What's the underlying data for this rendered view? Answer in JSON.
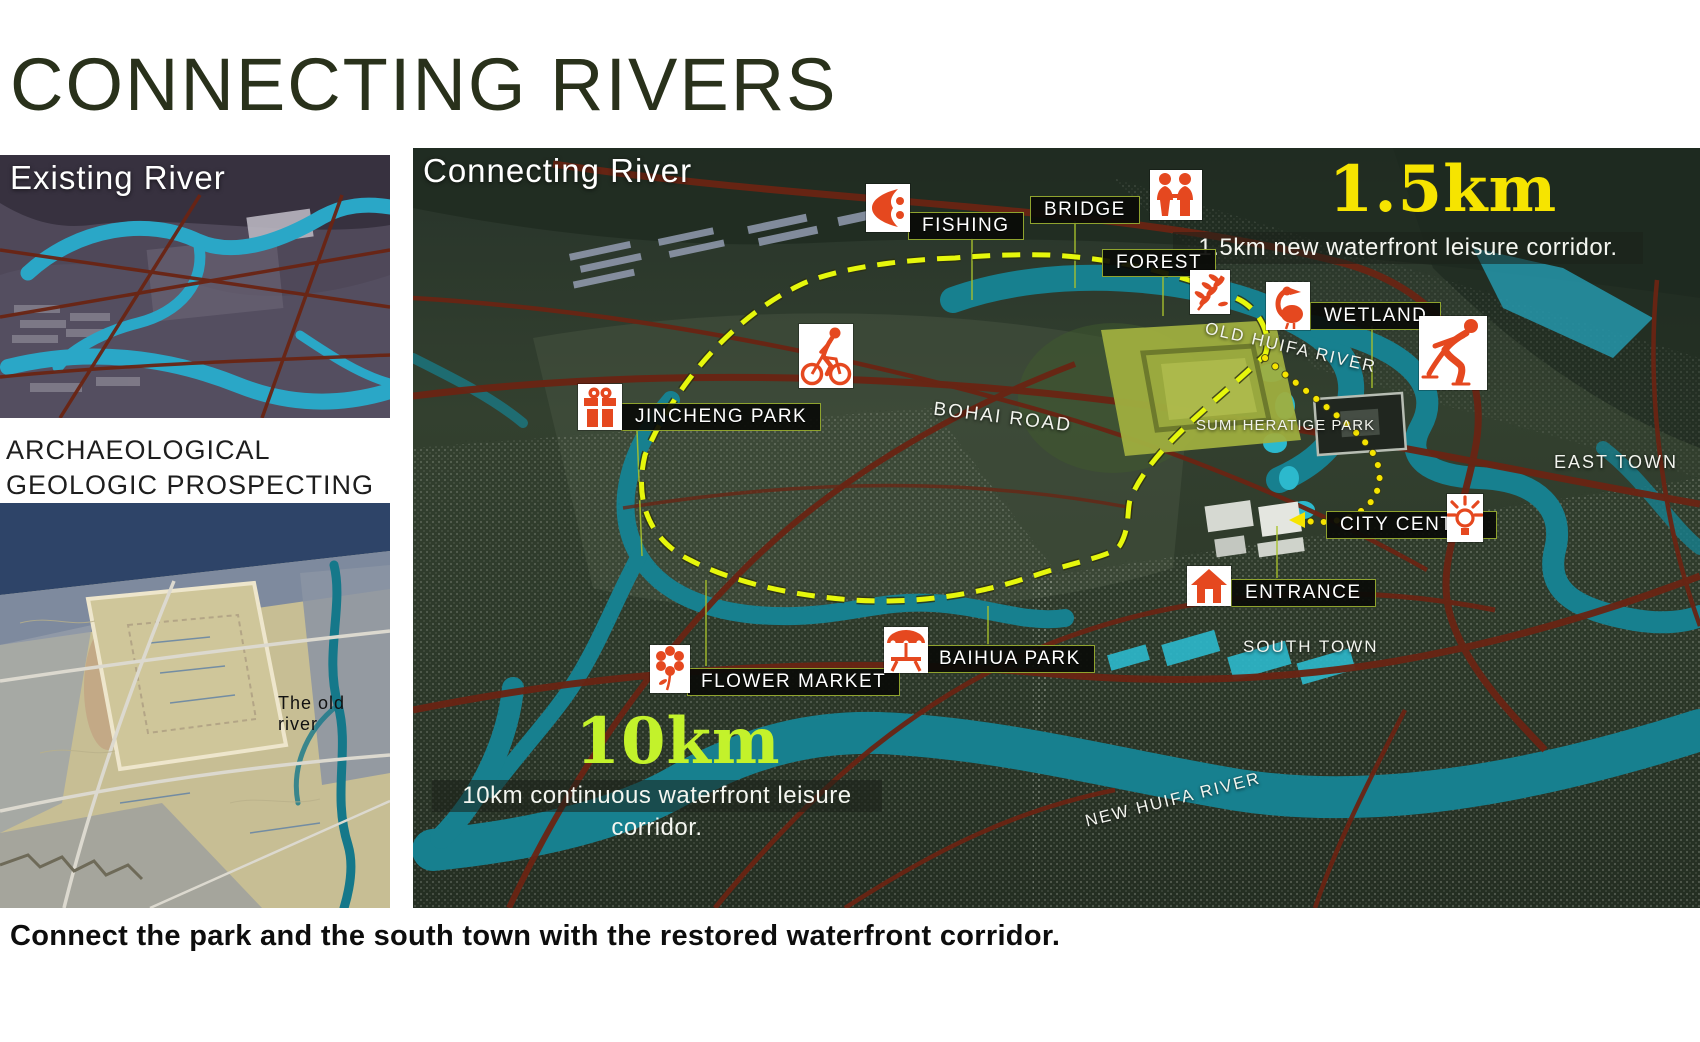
{
  "slide": {
    "title": "CONNECTING RIVERS",
    "footer_caption": "Connect the park and the south town with the restored waterfront corridor."
  },
  "left_column": {
    "existing_river_title": "Existing River",
    "prospecting_line1": "ARCHAEOLOGICAL",
    "prospecting_line2": "GEOLOGIC PROSPECTING",
    "old_river_label": "The old river"
  },
  "main_map": {
    "title": "Connecting River",
    "stats": [
      {
        "value": "1.5km",
        "description": "1.5km new waterfront leisure corridor.",
        "color": "#f6e400"
      },
      {
        "value": "10km",
        "description": "10km continuous waterfront leisure corridor.",
        "color": "#c3f22b"
      }
    ],
    "pois": [
      {
        "label": "FISHING",
        "icon": "fish-icon"
      },
      {
        "label": "BRIDGE",
        "icon": "couple-icon"
      },
      {
        "label": "FOREST",
        "icon": "leaf-icon"
      },
      {
        "label": "WETLAND",
        "icon": "pelican-icon"
      },
      {
        "label": "CITY CENTRE",
        "icon": "lightbulb-icon"
      },
      {
        "label": "ENTRANCE",
        "icon": "house-icon"
      },
      {
        "label": "FLOWER MARKET",
        "icon": "flower-icon"
      },
      {
        "label": "BAIHUA PARK",
        "icon": "umbrella-icon"
      },
      {
        "label": "JINCHENG PARK",
        "icon": "gift-icon"
      }
    ],
    "unlabeled_icons": [
      "cyclist-icon",
      "skater-icon"
    ],
    "place_labels": {
      "bohai_road": "BOHAI  ROAD",
      "old_huifa_river": "OLD HUIFA RIVER",
      "sumi_heratige_park": "SUMI HERATIGE PARK",
      "east_town": "EAST TOWN",
      "south_town": "SOUTH TOWN",
      "new_huifa_river": "NEW HUIFA RIVER"
    }
  },
  "colors": {
    "title_green": "#29311b",
    "accent_red": "#e5481f",
    "route_yellow": "#e6f70c",
    "river_teal": "#17808f",
    "road_brown": "#6a2413",
    "label_border": "#8fa32e"
  }
}
